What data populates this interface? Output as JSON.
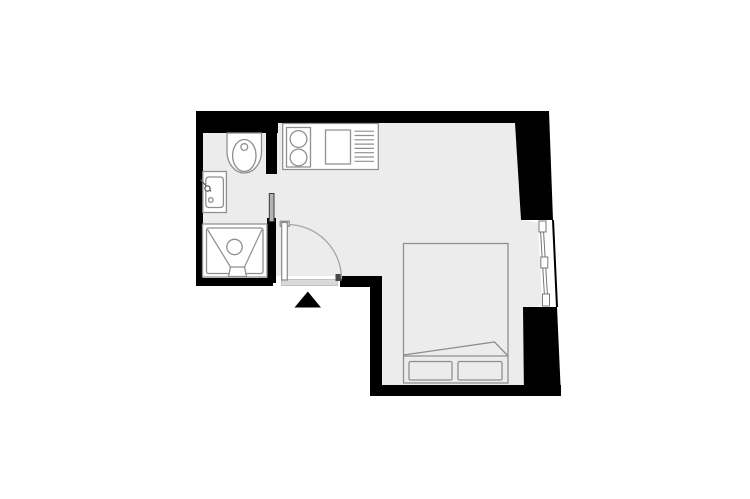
{
  "plan": {
    "type": "studio-apartment-floor-plan",
    "colors": {
      "background": "#ffffff",
      "wall": "#000000",
      "floor": "#ececec",
      "fixture_fill": "#ffffff",
      "fixture_stroke": "#8f8f8f",
      "window_frame": "#777777",
      "door_arc": "#a6a6a6",
      "door_jamb": "#474747",
      "threshold": "#d9d9d9",
      "sliding_door": "#b3b3b3",
      "entrance_marker": "#000000"
    },
    "fixtures": [
      "toilet",
      "washbasin",
      "shower",
      "sliding-door",
      "kitchen-counter",
      "cooktop",
      "kitchen-sink",
      "drainer-rack",
      "entrance-door",
      "door-swing",
      "entrance-marker",
      "window",
      "double-bed",
      "pillows"
    ]
  }
}
